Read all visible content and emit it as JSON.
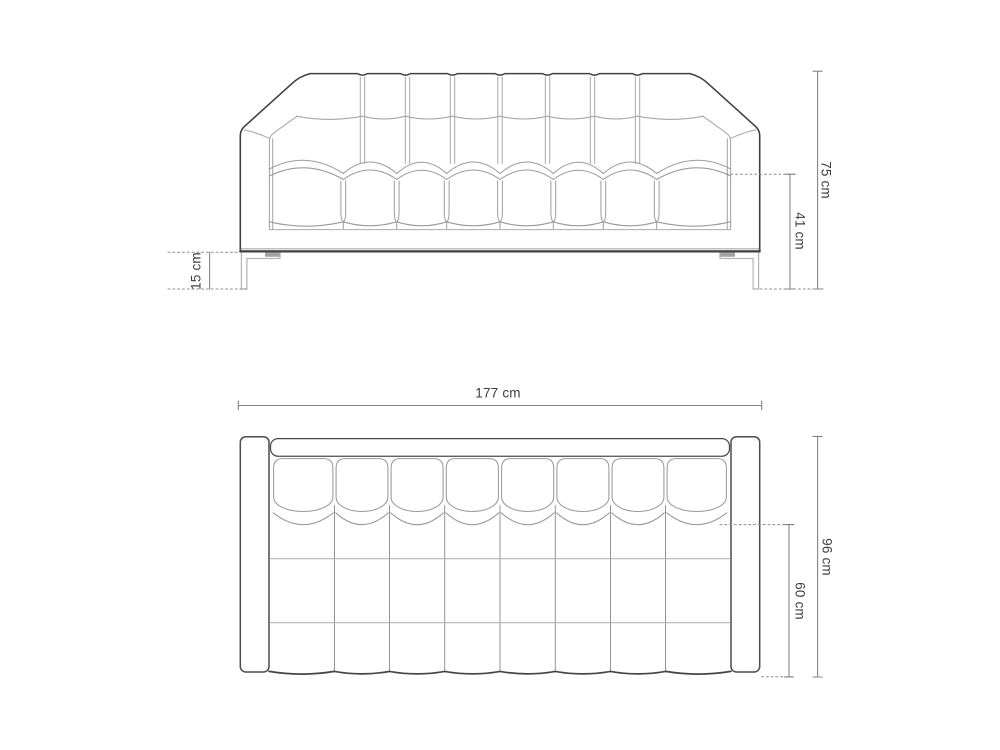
{
  "diagram_type": "sofa technical dimension drawing, front elevation and top plan view",
  "colors": {
    "background": "#ffffff",
    "outline_dark": "#414141",
    "seam_light": "#a6a6a6",
    "dimension_line": "#848484",
    "dashed_line": "#8c8c8c",
    "label_text": "#3e3e3e",
    "leg_line": "#b5b5b5"
  },
  "front_view": {
    "dimension_labels": {
      "total_height": "75 cm",
      "seat_height": "41 cm",
      "leg_height": "15 cm"
    }
  },
  "top_view": {
    "dimension_labels": {
      "total_width": "177 cm",
      "total_depth": "96 cm",
      "seat_depth": "60 cm"
    }
  }
}
